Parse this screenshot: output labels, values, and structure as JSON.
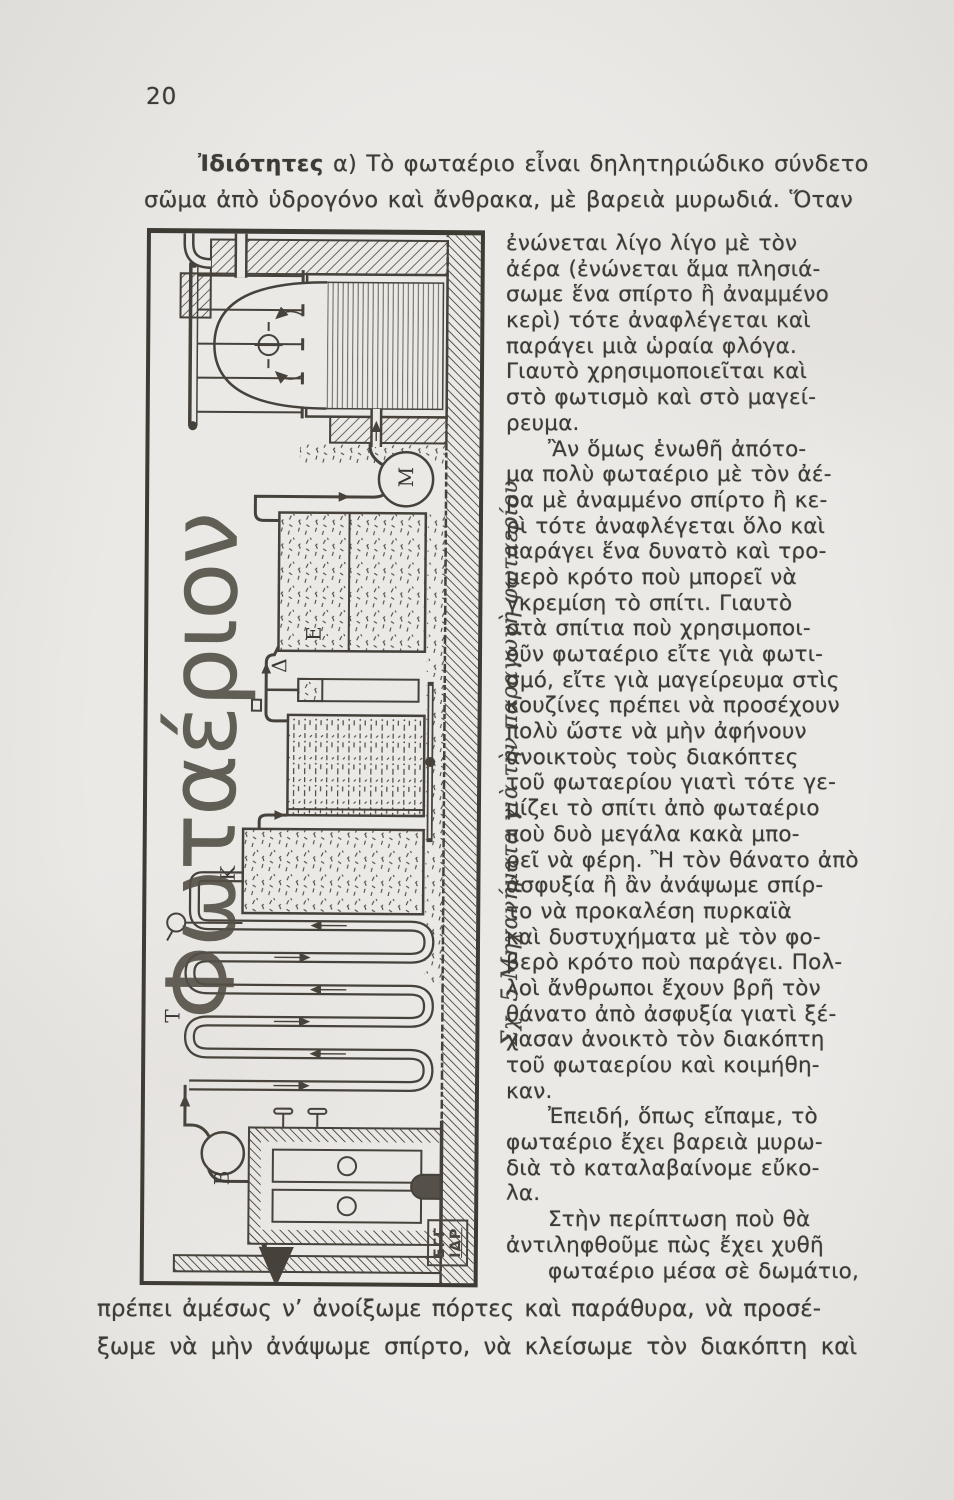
{
  "page": {
    "number": "20"
  },
  "intro": {
    "lead": "Ἰδιότητες",
    "line1_rest": " α) Τὸ φωταέριο εἶναι δηλητηριώδικο σύνδετο",
    "line2": "σῶμα ἀπὸ ὑδρογόνο καὶ ἄνθρακα, μὲ βαρειὰ μυρωδιά. Ὅταν"
  },
  "figure": {
    "vertical_title": "Φωταέριον",
    "caption": "Σχ. 5 Μηχανήματα γιὰ τὴν παραγωγὴ φωταερίου",
    "part_labels": {
      "condenser": "T",
      "washer": "B",
      "scrubber": "K",
      "valve_column": "Δ",
      "purifier": "E",
      "pot": "M"
    },
    "stamp": {
      "line1": "ΕΓΓ",
      "line2": "ΙΔΡ"
    }
  },
  "column": {
    "lines": [
      {
        "t": "ἐνώνεται λίγο λίγο μὲ τὸν",
        "i": 0
      },
      {
        "t": "ἀέρα (ἐνώνεται ἅμα πλησιά-",
        "i": 0
      },
      {
        "t": "σωμε ἕνα σπίρτο ἢ ἀναμμένο",
        "i": 0
      },
      {
        "t": "κερὶ) τότε ἀναφλέγεται καὶ",
        "i": 0
      },
      {
        "t": "παράγει μιὰ ὡραία φλόγα.",
        "i": 0
      },
      {
        "t": "Γιαυτὸ χρησιμοποιεῖται καὶ",
        "i": 0
      },
      {
        "t": "στὸ φωτισμὸ καὶ στὸ μαγεί-",
        "i": 0
      },
      {
        "t": "ρευμα.",
        "i": 0
      },
      {
        "t": "Ἂν ὅμως ἑνωθῆ ἀπότο-",
        "i": 1
      },
      {
        "t": "μα πολὺ φωταέριο μὲ τὸν ἀέ-",
        "i": 0
      },
      {
        "t": "ρα μὲ ἀναμμένο σπίρτο ἢ κε-",
        "i": 0
      },
      {
        "t": "ρὶ τότε ἀναφλέγεται ὅλο καὶ",
        "i": 0
      },
      {
        "t": "παράγει ἕνα δυνατὸ καὶ τρο-",
        "i": 0
      },
      {
        "t": "μερὸ κρότο ποὺ μπορεῖ νὰ",
        "i": 0
      },
      {
        "t": "γκρεμίση τὸ σπίτι. Γιαυτὸ",
        "i": 0
      },
      {
        "t": "στὰ σπίτια ποὺ χρησιμοποι-",
        "i": 0
      },
      {
        "t": "οῦν φωταέριο εἴτε γιὰ φωτι-",
        "i": 0
      },
      {
        "t": "σμό, εἴτε γιὰ μαγείρευμα στὶς",
        "i": 0
      },
      {
        "t": "κουζίνες πρέπει νὰ προσέχουν",
        "i": 0
      },
      {
        "t": "πολὺ ὥστε νὰ μὴν ἀφήνουν",
        "i": 0
      },
      {
        "t": "ἀνοικτοὺς τοὺς διακόπτες",
        "i": 0
      },
      {
        "t": "τοῦ φωταερίου γιατὶ τότε γε-",
        "i": 0
      },
      {
        "t": "μίζει τὸ σπίτι ἀπὸ φωταέριο",
        "i": 0
      },
      {
        "t": "ποὺ δυὸ μεγάλα κακὰ μπο-",
        "i": 0
      },
      {
        "t": "ρεῖ νὰ φέρη. Ἢ τὸν θάνατο ἀπὸ",
        "i": 0
      },
      {
        "t": "ἀσφυξία ἢ ἂν ἀνάψωμε σπίρ-",
        "i": 0
      },
      {
        "t": "το νὰ προκαλέση πυρκαϊὰ",
        "i": 0
      },
      {
        "t": "καὶ δυστυχήματα μὲ τὸν φο-",
        "i": 0
      },
      {
        "t": "βερὸ κρότο ποὺ παράγει. Πολ-",
        "i": 0
      },
      {
        "t": "λοὶ ἄνθρωποι ἔχουν βρῆ τὸν",
        "i": 0
      },
      {
        "t": "θάνατο ἀπὸ ἀσφυξία γιατὶ ξέ-",
        "i": 0
      },
      {
        "t": "χασαν ἀνοικτὸ τὸν διακόπτη",
        "i": 0
      },
      {
        "t": "τοῦ φωταερίου καὶ κοιμήθη-",
        "i": 0
      },
      {
        "t": "καν.",
        "i": 0
      },
      {
        "t": "Ἐπειδή, ὅπως εἴπαμε, τὸ",
        "i": 1
      },
      {
        "t": "φωταέριο ἔχει βαρειὰ μυρω-",
        "i": 0
      },
      {
        "t": "διὰ τὸ καταλαβαίνομε εὔκο-",
        "i": 0
      },
      {
        "t": "λα.",
        "i": 0
      },
      {
        "t": "Στὴν περίπτωση ποὺ θὰ",
        "i": 1
      },
      {
        "t": "ἀντιληφθοῦμε πὼς ἔχει χυθῆ",
        "i": 0
      },
      {
        "t": "φωταέριο μέσα σὲ δωμάτιο,",
        "i": 1
      }
    ]
  },
  "footer": {
    "line1": "πρέπει ἀμέσως ν’ ἀνοίξωμε πόρτες καὶ παράθυρα, νὰ προσέ-",
    "line2": "ξωμε νὰ μὴν ἀνάψωμε σπίρτο, νὰ κλείσωμε τὸν διακόπτη καὶ"
  }
}
